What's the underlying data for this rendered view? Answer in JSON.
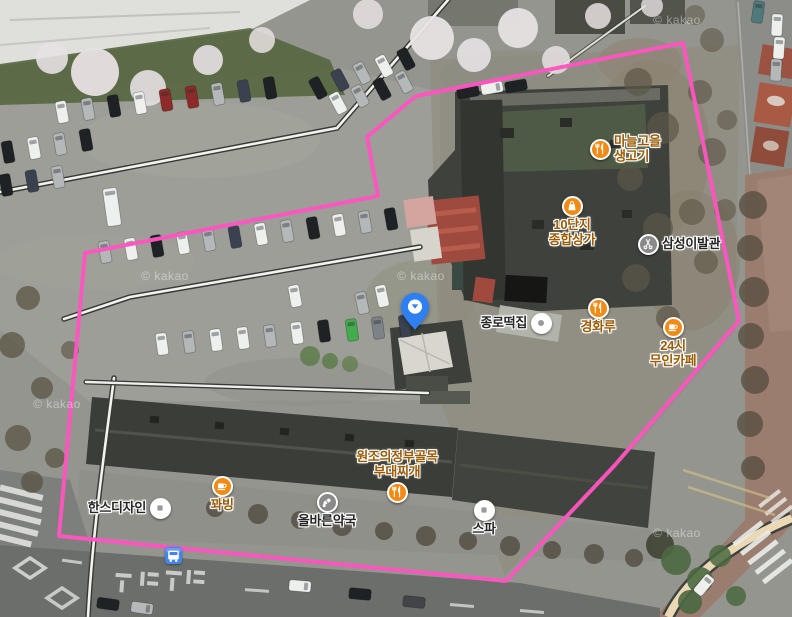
{
  "map": {
    "provider_watermark": "© kakao",
    "colors": {
      "boundary_pink": "#fd55c0",
      "pin_blue": "#2e7ff2",
      "poi_icon_orange": "#f28a14",
      "poi_icon_gray": "#8a8a8a",
      "poi_icon_white": "#ffffff",
      "poi_text_orange": "#9a5b05",
      "poi_text_dark": "#262626",
      "bus_icon_blue": "#4484ef"
    },
    "boundary": {
      "points": "85,253 378,196 367,137 416,96 683,43 739,321 615,465 506,581 59,536"
    },
    "pin": {
      "x": 415,
      "y": 331
    },
    "bus_stop": {
      "x": 173,
      "y": 555
    },
    "watermarks": [
      {
        "x": 165,
        "y": 276
      },
      {
        "x": 421,
        "y": 276
      },
      {
        "x": 677,
        "y": 20
      },
      {
        "x": 677,
        "y": 533
      },
      {
        "x": 57,
        "y": 404
      }
    ],
    "pois": [
      {
        "id": "manul-gogi",
        "label": "마늘고을\n생고기",
        "icon": "restaurant",
        "style": "orange",
        "arrange": "icon-left",
        "x": 600,
        "y": 149
      },
      {
        "id": "danji-mall",
        "label": "10단지\n종합상가",
        "icon": "shop",
        "style": "orange",
        "arrange": "icon-top",
        "x": 572,
        "y": 206
      },
      {
        "id": "samsung-barber",
        "label": "삼성이발관",
        "icon": "barber",
        "style": "gray",
        "arrange": "icon-left",
        "x": 648,
        "y": 244
      },
      {
        "id": "jongno-tteok",
        "label": "종로떡집",
        "icon": "dot",
        "style": "white",
        "arrange": "icon-right",
        "x": 541,
        "y": 323
      },
      {
        "id": "gyeonghwaru",
        "label": "경화루",
        "icon": "restaurant",
        "style": "orange",
        "arrange": "icon-top",
        "x": 598,
        "y": 308
      },
      {
        "id": "cafe-24h",
        "label": "24시\n무인카페",
        "icon": "cafe",
        "style": "orange",
        "arrange": "icon-top",
        "x": 673,
        "y": 327
      },
      {
        "id": "budae-jjigae",
        "label": "원조의정부골목\n부대찌개",
        "icon": "restaurant",
        "style": "orange",
        "arrange": "icon-bottom",
        "x": 397,
        "y": 492
      },
      {
        "id": "hans-design",
        "label": "한스디자인",
        "icon": "square",
        "style": "white",
        "arrange": "icon-right",
        "x": 160,
        "y": 508
      },
      {
        "id": "kkwabing",
        "label": "꽈빙",
        "icon": "cafe",
        "style": "orange",
        "arrange": "icon-top",
        "x": 222,
        "y": 486
      },
      {
        "id": "olbareun-pharmacy",
        "label": "올바른약국",
        "icon": "pharmacy",
        "style": "gray",
        "arrange": "icon-top",
        "x": 327,
        "y": 502
      },
      {
        "id": "spa",
        "label": "스파",
        "icon": "square",
        "style": "white",
        "arrange": "icon-top",
        "x": 484,
        "y": 510
      }
    ]
  }
}
